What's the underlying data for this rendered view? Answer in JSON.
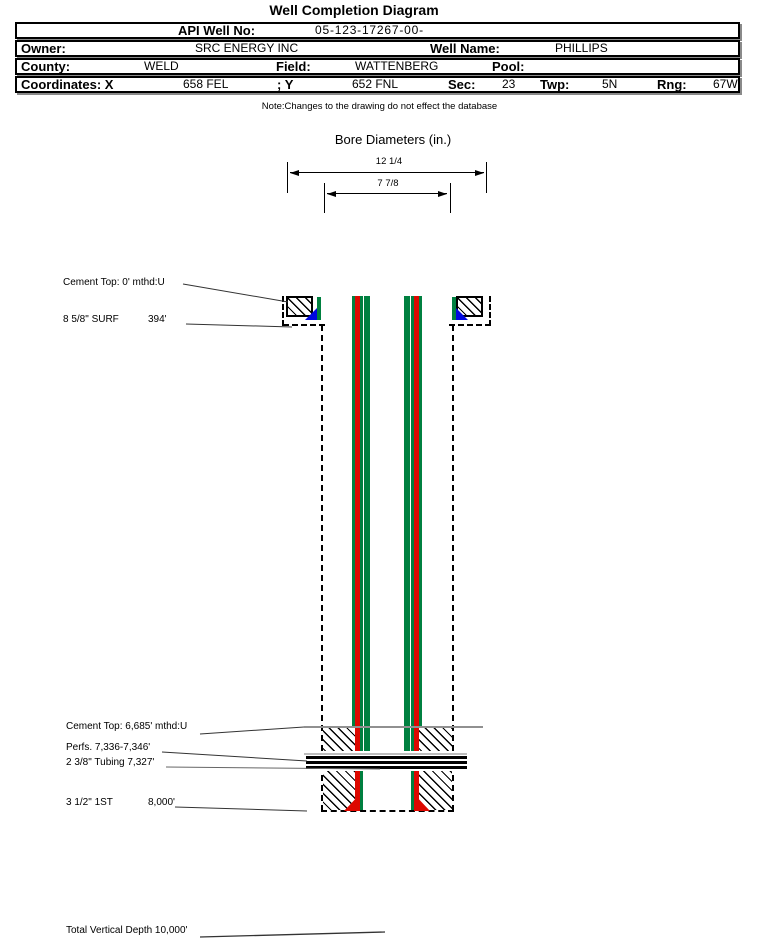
{
  "title": "Well Completion Diagram",
  "note": "Note:Changes to the drawing do not effect the database",
  "header": {
    "api_label": "API Well No:",
    "api_value": "05-123-17267-00-",
    "owner_label": "Owner:",
    "owner_value": "SRC ENERGY INC",
    "well_name_label": "Well Name:",
    "well_name_value": "PHILLIPS",
    "county_label": "County:",
    "county_value": "WELD",
    "field_label": "Field:",
    "field_value": "WATTENBERG",
    "pool_label": "Pool:",
    "pool_value": "",
    "coordinates_label": "Coordinates: X",
    "coord_x_value": "658 FEL",
    "coord_y_label": "; Y",
    "coord_y_value": "652 FNL",
    "sec_label": "Sec:",
    "sec_value": "23",
    "twp_label": "Twp:",
    "twp_value": "5N",
    "rng_label": "Rng:",
    "rng_value": "67W"
  },
  "bore_diameters": {
    "title": "Bore Diameters (in.)",
    "outer_diameter": "12 1/4",
    "inner_diameter": "7 7/8"
  },
  "annotations": {
    "cement_top_surface": "Cement Top: 0' mthd:U",
    "surface_casing": "8 5/8\" SURF",
    "surface_casing_depth": "394'",
    "cement_top_production": "Cement Top: 6,685' mthd:U",
    "perfs": "Perfs. 7,336-7,346'",
    "tubing": "2 3/8\" Tubing 7,327'",
    "production_string": "3 1/2\" 1ST",
    "production_string_depth": "8,000'",
    "total_vertical_depth": "Total Vertical Depth 10,000'"
  },
  "colors": {
    "casing_red": "#dd0800",
    "casing_green": "#008040",
    "shoe_blue": "#0008e0"
  }
}
